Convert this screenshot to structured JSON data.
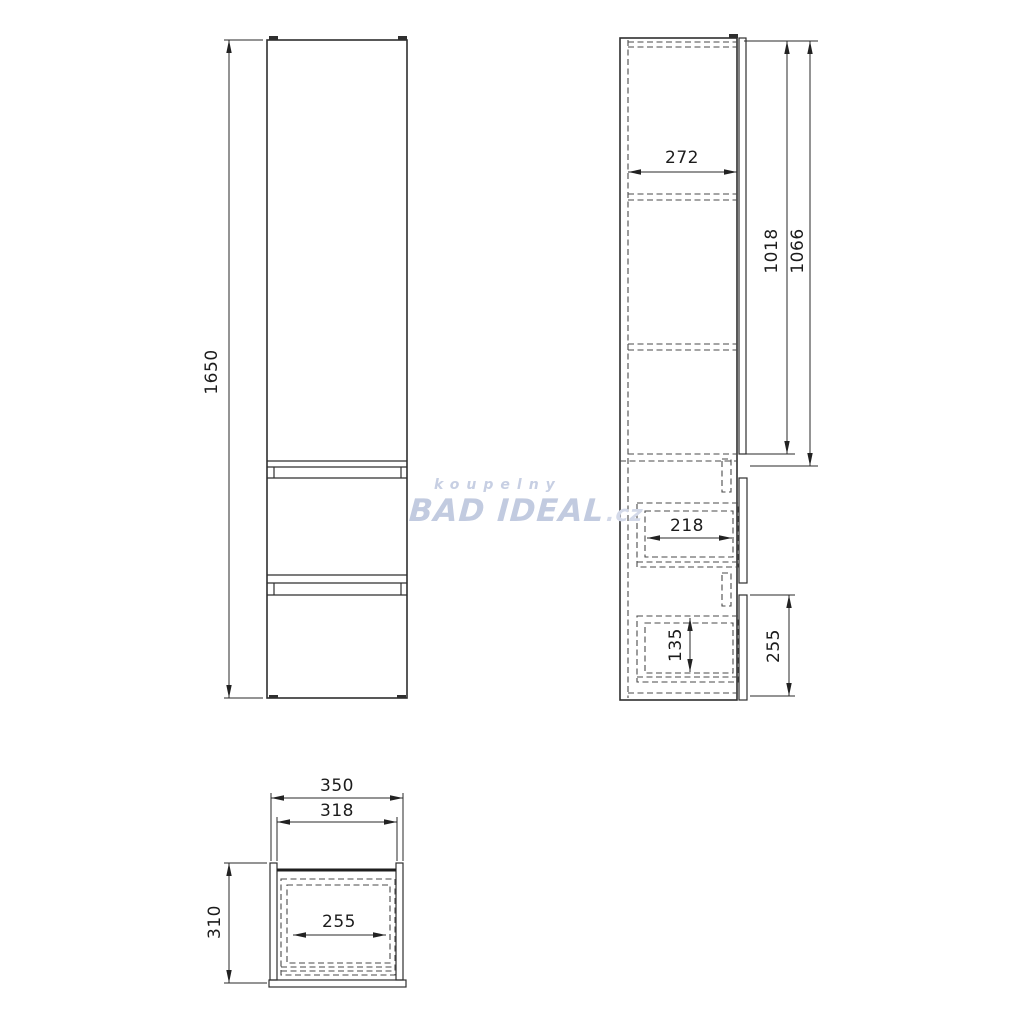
{
  "page": {
    "background_color": "#ffffff",
    "line_color": "#2f2f2f",
    "hidden_line_color": "#4a4a4a"
  },
  "watermark": {
    "top_text": "koupelny",
    "brand": "BAD IDEAL",
    "suffix": ".cz",
    "color": "#c2cbe0"
  },
  "front_view": {
    "height_label": "1650"
  },
  "side_view": {
    "inner_depth_label": "272",
    "door_height_label": "1018",
    "upper_section_label": "1066",
    "drawer_depth_label": "218",
    "drawer_inner_height_label": "135",
    "drawer_front_height_label": "255"
  },
  "top_view": {
    "width_label": "350",
    "inner_width_label": "318",
    "drawer_width_label": "255",
    "depth_label": "310"
  }
}
